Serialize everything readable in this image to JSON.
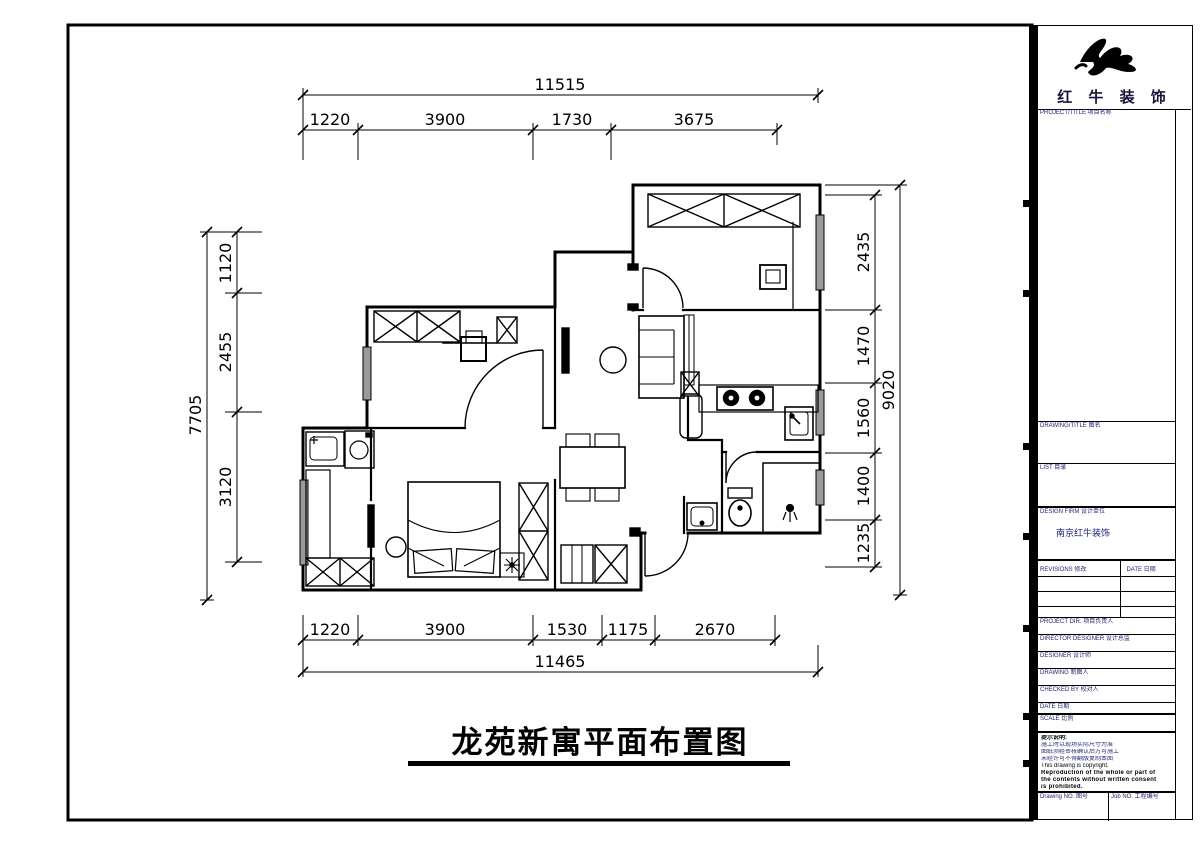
{
  "plan_title": {
    "text": "龙苑新寓平面布置图"
  },
  "dimensions": {
    "top": {
      "total": "11515",
      "segments": [
        "1220",
        "3900",
        "1730",
        "3675"
      ]
    },
    "bottom": {
      "total": "11465",
      "segments": [
        "1220",
        "3900",
        "1530",
        "1175",
        "2670"
      ]
    },
    "left": {
      "total": "7705",
      "segments": [
        "1120",
        "2455",
        "3120"
      ]
    },
    "right": {
      "total": "9020",
      "segments": [
        "2435",
        "1470",
        "1560",
        "1400",
        "1235"
      ]
    }
  },
  "title_block": {
    "brand": "红 牛 装 饰",
    "logo_icon": "bull-brush-mark",
    "project_label": "PROJECT/TITLE 项目名称",
    "drawing_label": "DRAWING/TITLE 图名",
    "list_label": "LIST 目录",
    "firm_label": "DESIGN FIRM 设计单位",
    "firm_value": "南京红牛装饰",
    "revisions_label": "REVISIONS 修改",
    "date_col_label": "DATE 日期",
    "people_rows": [
      "PROJECT DIR. 项目负责人",
      "DIRECTOR DESIGNER 设计总监",
      "DESIGNER 设计师",
      "DRAWING 制图人",
      "CHECKED BY 校对人",
      "DATE 日期"
    ],
    "scale_label": "SCALE 比例",
    "notes": [
      "提示说明:",
      "施工时以现场实际尺寸为准",
      "图纸须经审核确认后方可施工",
      "未经许可不得翻版复制本图",
      "This drawing is copyright.",
      "Reproduction of the whole or part of",
      "the contents without written consent",
      "is prohibited."
    ],
    "drawing_no_label": "Drawing NO. 图号",
    "job_no_label": "Job NO. 工程编号"
  }
}
